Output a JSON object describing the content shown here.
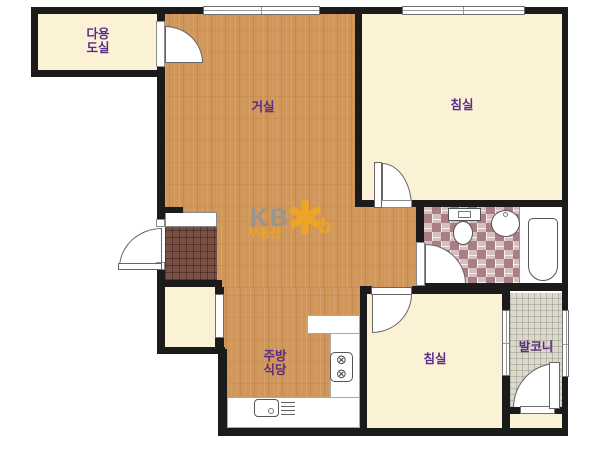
{
  "watermark": {
    "brand": "KB",
    "subtitle": "부동산",
    "star": "✱",
    "b": "b"
  },
  "rooms": {
    "utility": {
      "name": "다용도실",
      "line1": "다용",
      "line2": "도실"
    },
    "living": {
      "label": "거실"
    },
    "bedroom_top": {
      "label": "침실"
    },
    "bedroom_bottom": {
      "label": "침실"
    },
    "kitchen": {
      "name": "주방식당",
      "line1": "주방",
      "line2": "식당"
    },
    "balcony": {
      "label": "발코니"
    }
  },
  "icons": {
    "stove_burner": "⊗"
  },
  "colors": {
    "wall": "#1b1b1b",
    "room_cream": "#fbf2d6",
    "floor_wood": "#d0965a",
    "entry_tile": "#7a5044",
    "bath_tile": "#aa7f84",
    "balcony_tile": "#dcd9ca",
    "label": "#5b2c87",
    "kb_gray": "#8e959c",
    "kb_orange": "#f4a81d"
  }
}
